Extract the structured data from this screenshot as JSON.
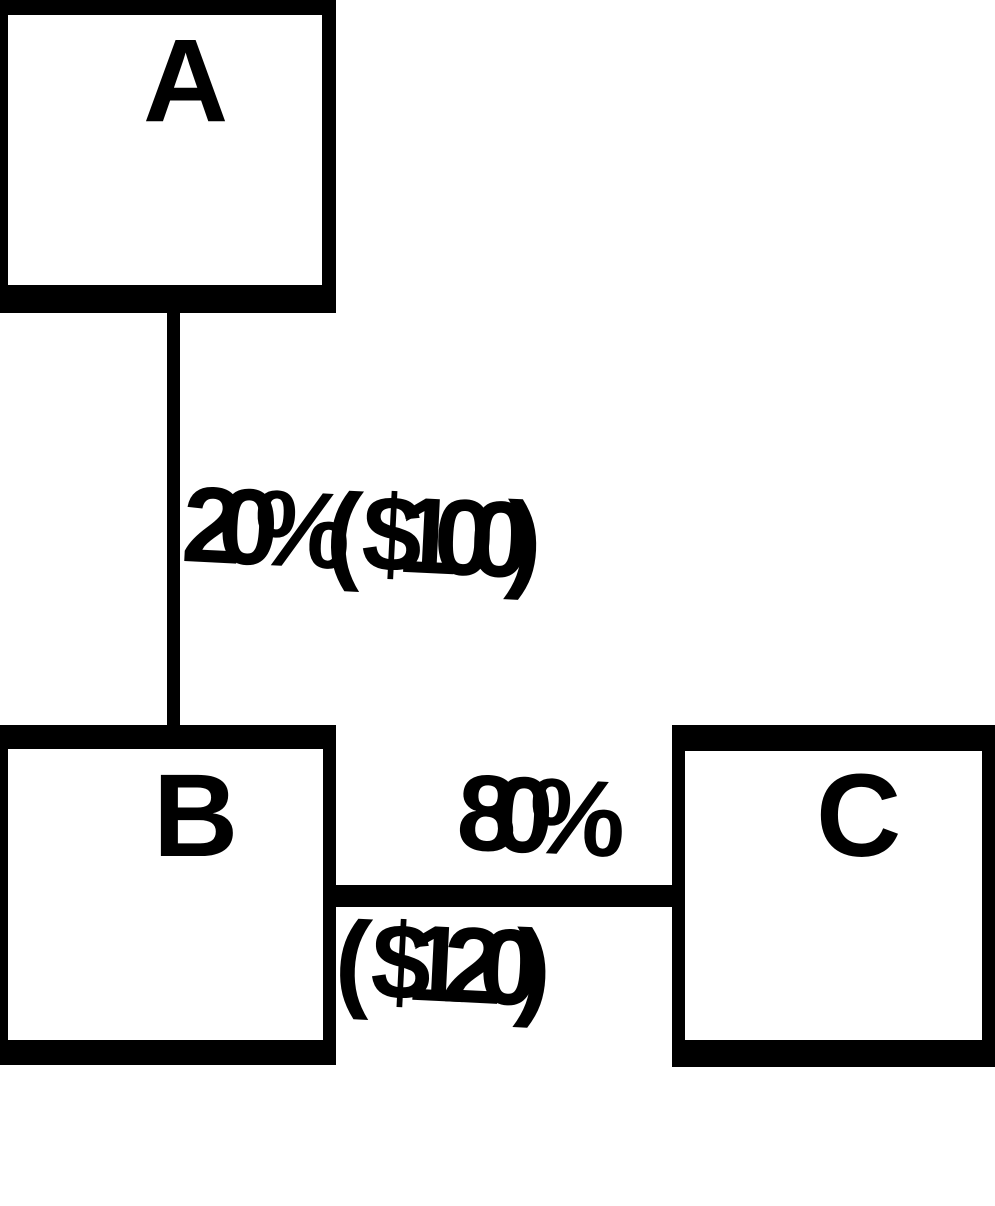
{
  "diagram": {
    "background": "#ffffff",
    "ink": "#000000",
    "nodes": [
      {
        "id": "A",
        "label": "A"
      },
      {
        "id": "B",
        "label": "B"
      },
      {
        "id": "C",
        "label": "C"
      }
    ],
    "edges": [
      {
        "from": "A",
        "to": "B",
        "orientation": "vertical",
        "label_lines": [
          "20% ($100)"
        ]
      },
      {
        "from": "B",
        "to": "C",
        "orientation": "horizontal",
        "label_lines": [
          "80%",
          "($120)"
        ]
      }
    ]
  }
}
